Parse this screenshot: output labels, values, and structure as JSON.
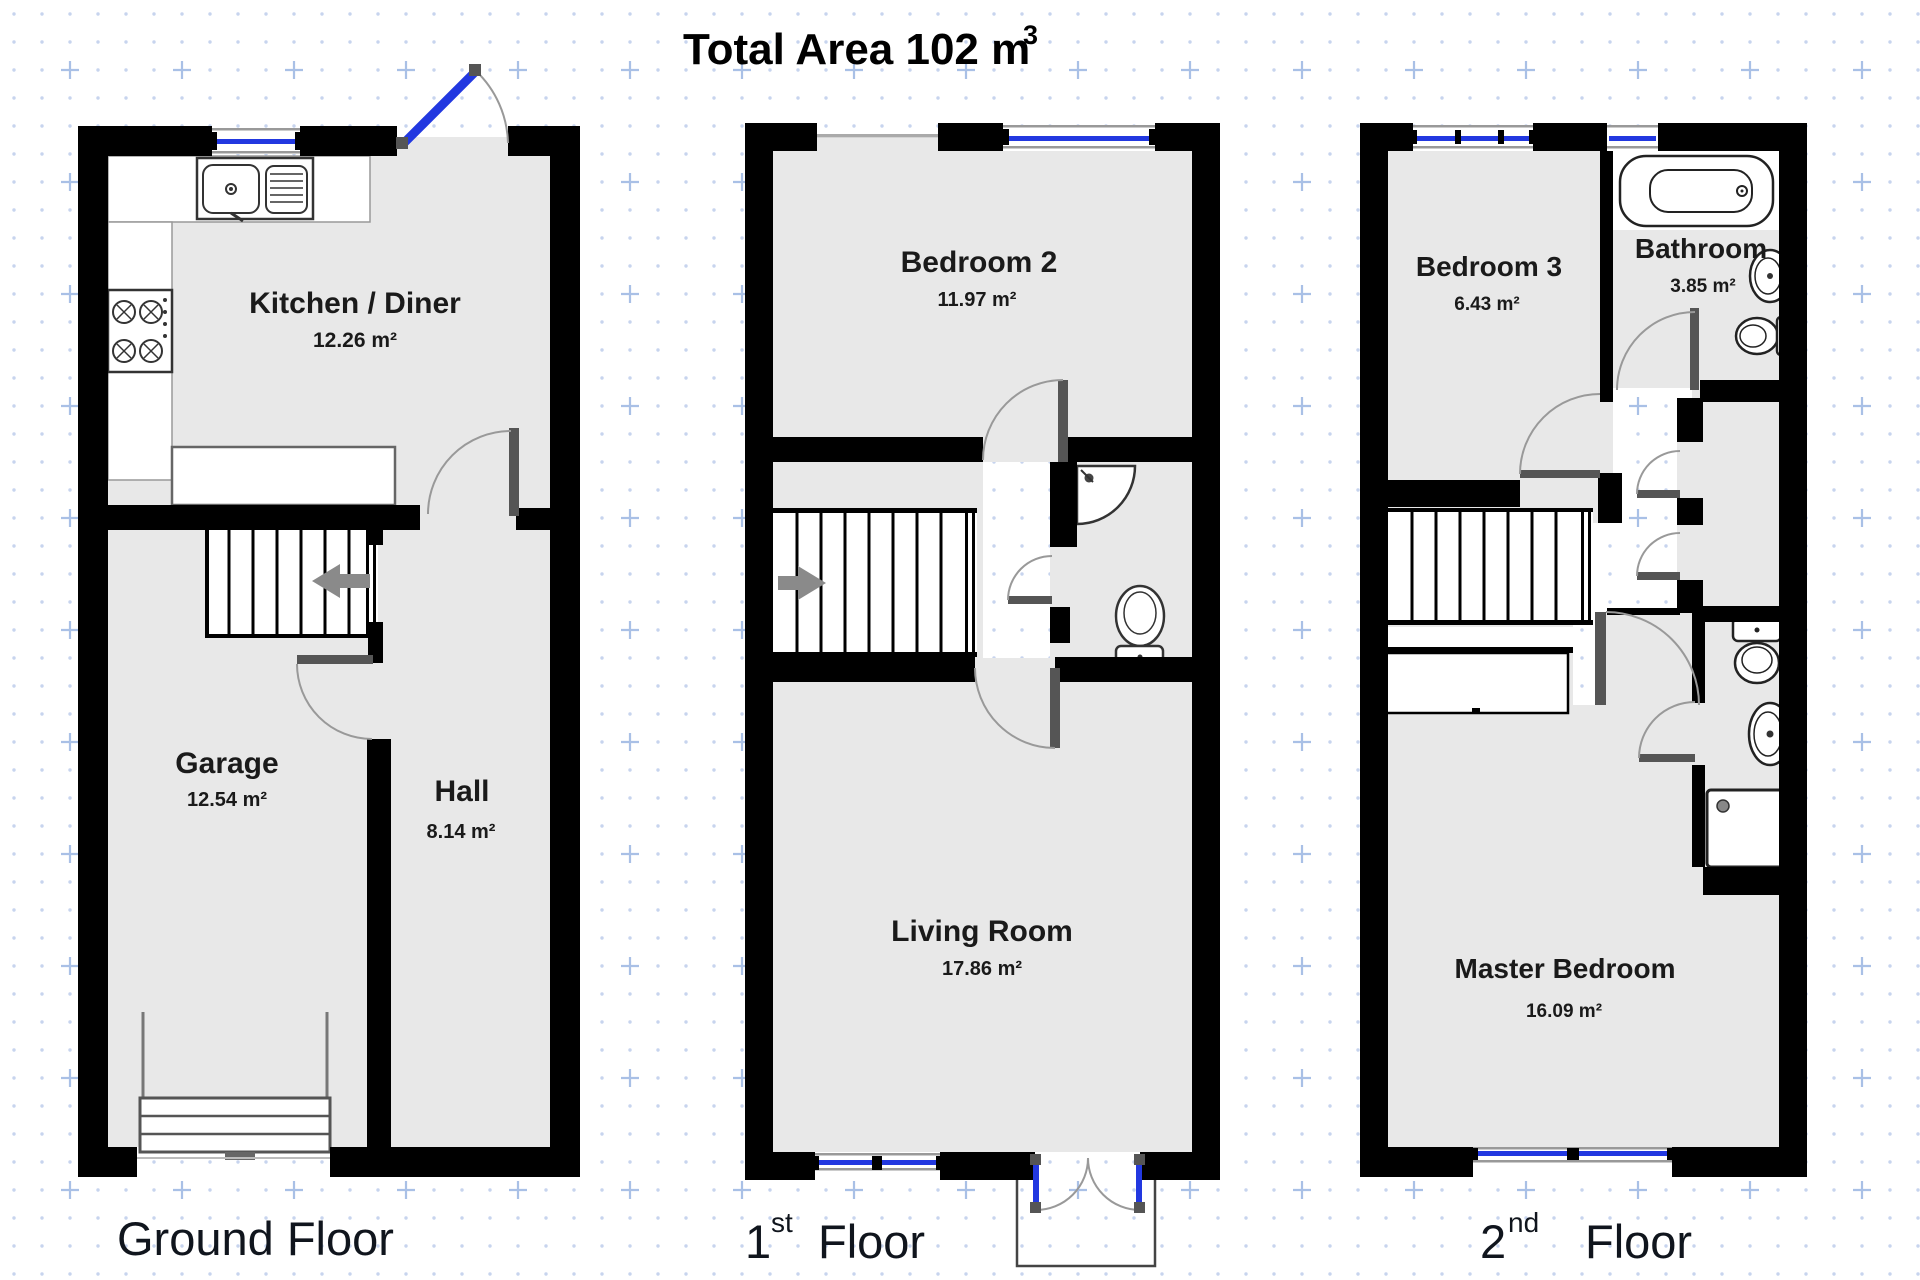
{
  "title": {
    "main": "Total Area 102 m",
    "sup": "3"
  },
  "floors": {
    "ground": {
      "caption": "Ground Floor",
      "kitchen": {
        "name": "Kitchen / Diner",
        "area": "12.26 m²"
      },
      "garage": {
        "name": "Garage",
        "area": "12.54 m²"
      },
      "hall": {
        "name": "Hall",
        "area": "8.14 m²"
      }
    },
    "first": {
      "caption_num": "1",
      "caption_ord": "st",
      "caption_word": "Floor",
      "bedroom2": {
        "name": "Bedroom 2",
        "area": "11.97 m²"
      },
      "living": {
        "name": "Living Room",
        "area": "17.86 m²"
      }
    },
    "second": {
      "caption_num": "2",
      "caption_ord": "nd",
      "caption_word": "Floor",
      "bedroom3": {
        "name": "Bedroom 3",
        "area": "6.43 m²"
      },
      "bathroom": {
        "name": "Bathroom",
        "area": "3.85 m²"
      },
      "master": {
        "name": "Master Bedroom",
        "area": "16.09 m²"
      }
    }
  },
  "colors": {
    "wall": "#000000",
    "room_fill": "#e8e8e8",
    "window_blue": "#2238e0",
    "open_door_blue": "#2238e0",
    "stair_arrow_gray": "#8a8a8a",
    "grid_blue": "#a9c0e6"
  }
}
